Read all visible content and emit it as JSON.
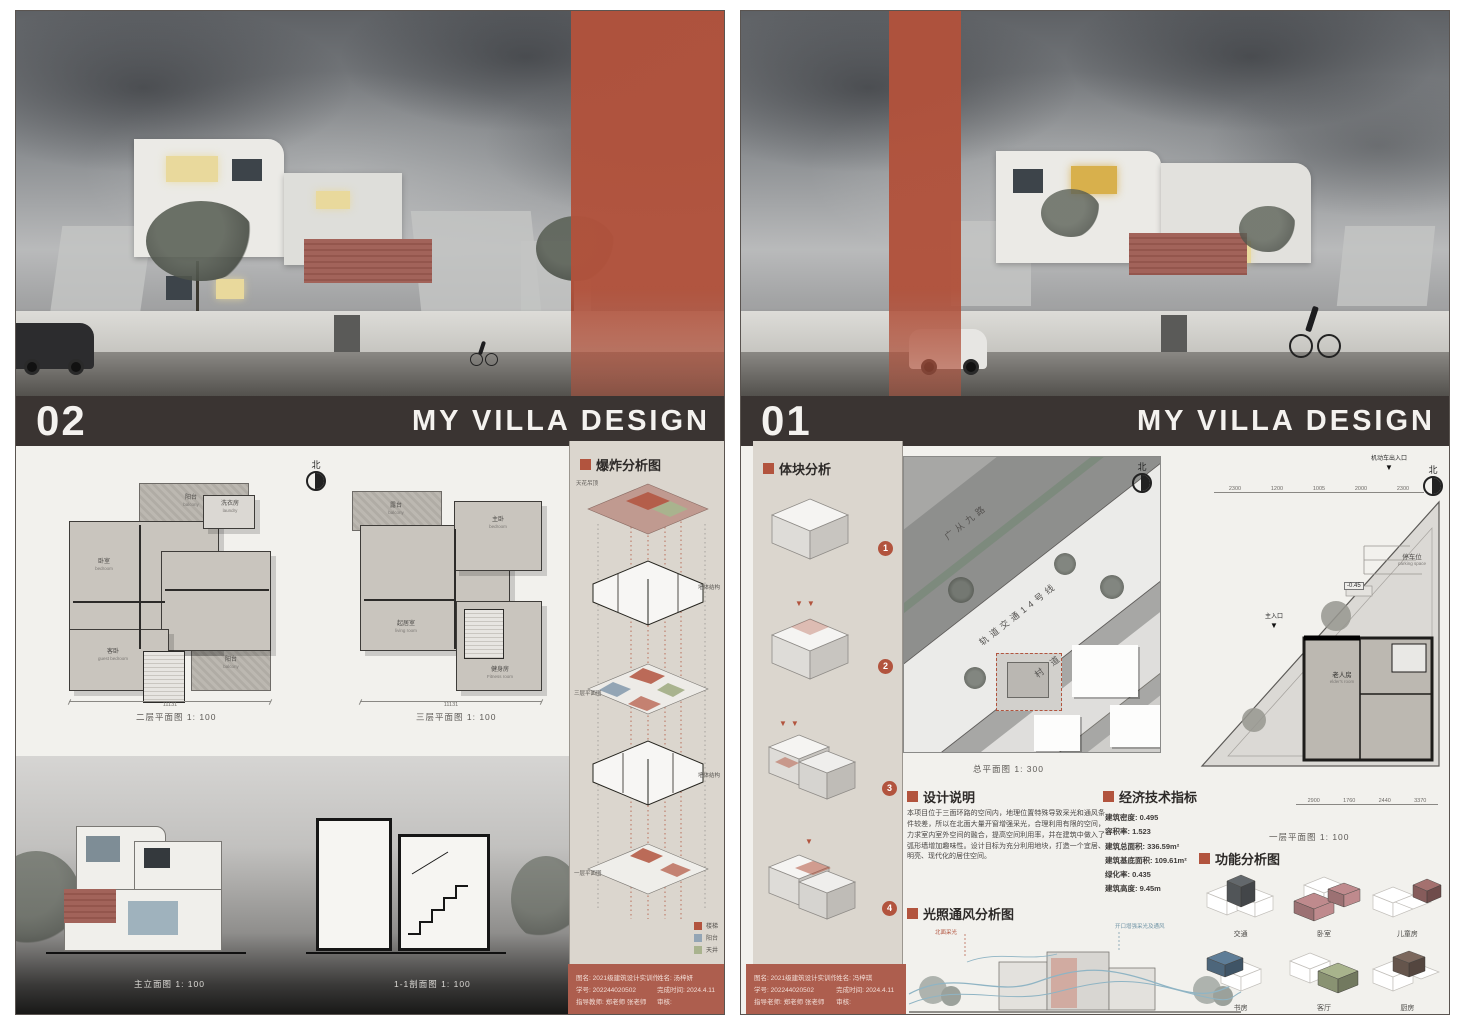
{
  "colors": {
    "accent": "#b2543e",
    "title_bar": "#3a3432",
    "panel_bg": "#dbd6ce"
  },
  "board_left": {
    "number": "02",
    "title": "MY VILLA DESIGN",
    "north_label": "北",
    "plan2": {
      "caption": "二层平面图 1: 100",
      "total_dim": "11131",
      "rooms": [
        {
          "cn": "阳台",
          "en": "balcony"
        },
        {
          "cn": "洗衣房",
          "en": "laundry"
        },
        {
          "cn": "卧室",
          "en": "bedroom"
        },
        {
          "cn": "客卧",
          "en": "guest bedroom"
        },
        {
          "cn": "阳台",
          "en": "balcony"
        }
      ]
    },
    "plan3": {
      "caption": "三层平面图 1: 100",
      "total_dim": "11131",
      "rooms": [
        {
          "cn": "露台",
          "en": "balcony"
        },
        {
          "cn": "主卧",
          "en": "bedroom"
        },
        {
          "cn": "起居室",
          "en": "living room"
        },
        {
          "cn": "健身房",
          "en": "Fitness room"
        }
      ]
    },
    "exploded": {
      "heading": "爆炸分析图",
      "labels": {
        "top": "天花吊顶",
        "walls3": "墙体结构",
        "plan3": "三层平面图",
        "walls2": "墙体结构",
        "plan2": "二层平面图",
        "walls1": "墙体结构",
        "plan1": "一层平面图"
      },
      "legend": [
        {
          "label": "楼梯",
          "color": "#b2543e"
        },
        {
          "label": "阳台",
          "color": "#93a5b5"
        },
        {
          "label": "天井",
          "color": "#a9b38e"
        }
      ]
    },
    "bottom": {
      "elevation_caption": "主立面图 1: 100",
      "section_caption": "1-1剖面图 1: 100"
    },
    "info": {
      "rows": [
        [
          "图名: 2021级建筑设计实训作业",
          "姓名: 汤梓妍"
        ],
        [
          "学号: 202244020502",
          "完成时间: 2024.4.11"
        ],
        [
          "指导教师: 郑老师 张老师",
          "审核:"
        ]
      ]
    }
  },
  "board_right": {
    "number": "01",
    "title": "MY VILLA DESIGN",
    "north_label": "北",
    "massing": {
      "heading": "体块分析",
      "steps": [
        "1",
        "2",
        "3",
        "4"
      ]
    },
    "site": {
      "caption": "总平面图 1: 300",
      "road1": "广从九路",
      "road2": "轨道交通14号线",
      "road3": "村 道"
    },
    "plan1": {
      "caption": "一层平面图 1: 100",
      "top_dims": [
        "2300",
        "1200",
        "1005",
        "2000",
        "2300"
      ],
      "bottom_dims": [
        "2900",
        "1760",
        "2440",
        "3370"
      ],
      "vehicle_entry": "机动车出入口",
      "parking_cn": "停车位",
      "parking_en": "parking space",
      "level": "-0.45",
      "main_entry": "主入口",
      "elder_cn": "老人房",
      "elder_en": "elder's room"
    },
    "description": {
      "heading": "设计说明",
      "text": "本项目位于三面环路的空间内，地理位置特殊导致采光和通风条件较差，所以在北面大量开窗增强采光，合理利用有限的空间，力求室内室外空间的融合，提高空间利用率，并在建筑中做入了弧形墙增加趣味性。设计目标为充分利用地块，打造一个宜居、明亮、现代化的居住空间。"
    },
    "indicators": {
      "heading": "经济技术指标",
      "items": [
        "建筑密度: 0.495",
        "容积率: 1.523",
        "建筑总面积: 336.59m²",
        "建筑基底面积: 109.61m²",
        "绿化率: 0.435",
        "建筑高度: 9.45m"
      ]
    },
    "light": {
      "heading": "光照通风分析图",
      "note_left": "北面采光",
      "note_right": "开口增强采光及通风"
    },
    "function": {
      "heading": "功能分析图",
      "items": [
        {
          "label": "交通",
          "color": "#63686c"
        },
        {
          "label": "卧室",
          "color": "#bf8a8d"
        },
        {
          "label": "儿童房",
          "color": "#a4716f"
        },
        {
          "label": "书房",
          "color": "#5e7d97"
        },
        {
          "label": "客厅",
          "color": "#a8b38c"
        },
        {
          "label": "厨房",
          "color": "#7c685d"
        }
      ]
    },
    "info": {
      "rows": [
        [
          "图名: 2021级建筑设计实训作业",
          "姓名: 冯梓琪"
        ],
        [
          "学号: 202244020502",
          "完成时间: 2024.4.11"
        ],
        [
          "指导老师: 郑老师 张老师",
          "审核:"
        ]
      ]
    }
  }
}
